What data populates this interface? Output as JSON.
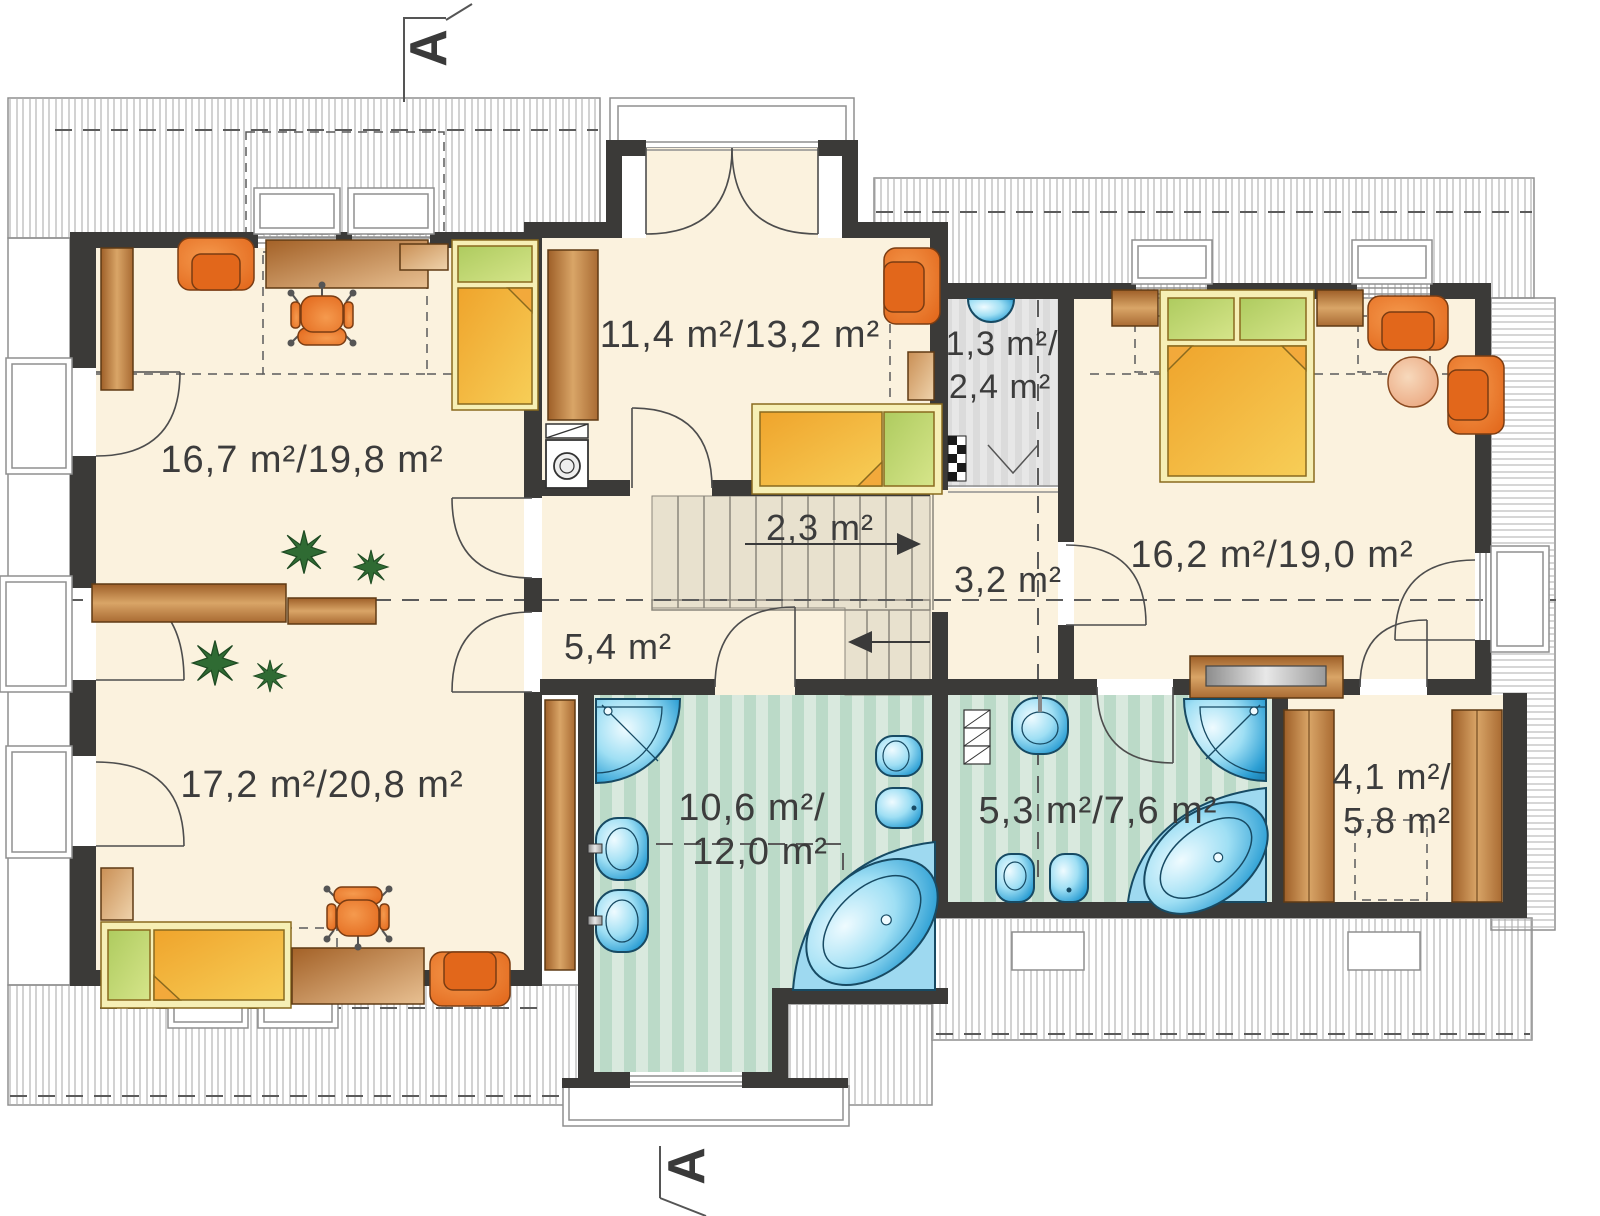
{
  "plan": {
    "title": "attic floor plan",
    "section_marker_top": "A",
    "section_marker_bottom": "A",
    "rooms": {
      "study": {
        "area": "16,7 m²/19,8 m²"
      },
      "middle_room": {
        "area": "11,4 m²/13,2 m²"
      },
      "wardrobe_top": {
        "area_line1": "1,3 m²/",
        "area_line2": "2,4 m²"
      },
      "bedroom_right": {
        "area": "16,2 m²/19,0 m²"
      },
      "stairs": {
        "area": "2,3 m²"
      },
      "hall_upper": {
        "area": "3,2 m²"
      },
      "hall_lower": {
        "area": "5,4 m²"
      },
      "room_bottom_left": {
        "area": "17,2 m²/20,8 m²"
      },
      "bathroom_main": {
        "area_line1": "10,6 m²/",
        "area_line2": "12,0 m²"
      },
      "bathroom_small": {
        "area": "5,3 m²/7,6 m²"
      },
      "closet_right": {
        "area_line1": "4,1 m²/",
        "area_line2": "5,8 m²"
      }
    },
    "colors": {
      "wall": "#3B3A38",
      "floor": "#FBF2DE",
      "bath_floor_stripe": "#BBDAC8",
      "bath_floor_base": "#D9E9DE",
      "gray_closet": "#DCDCDC",
      "stairs": "#E8E1CE",
      "wood": "#B06F33",
      "furniture_orange": "#E9731F",
      "bed_yellow": "#F4B73A",
      "pillow_green": "#BFD46F",
      "fixture_blue": "#3FB5E0",
      "label_text": "#3C3C3C"
    }
  }
}
